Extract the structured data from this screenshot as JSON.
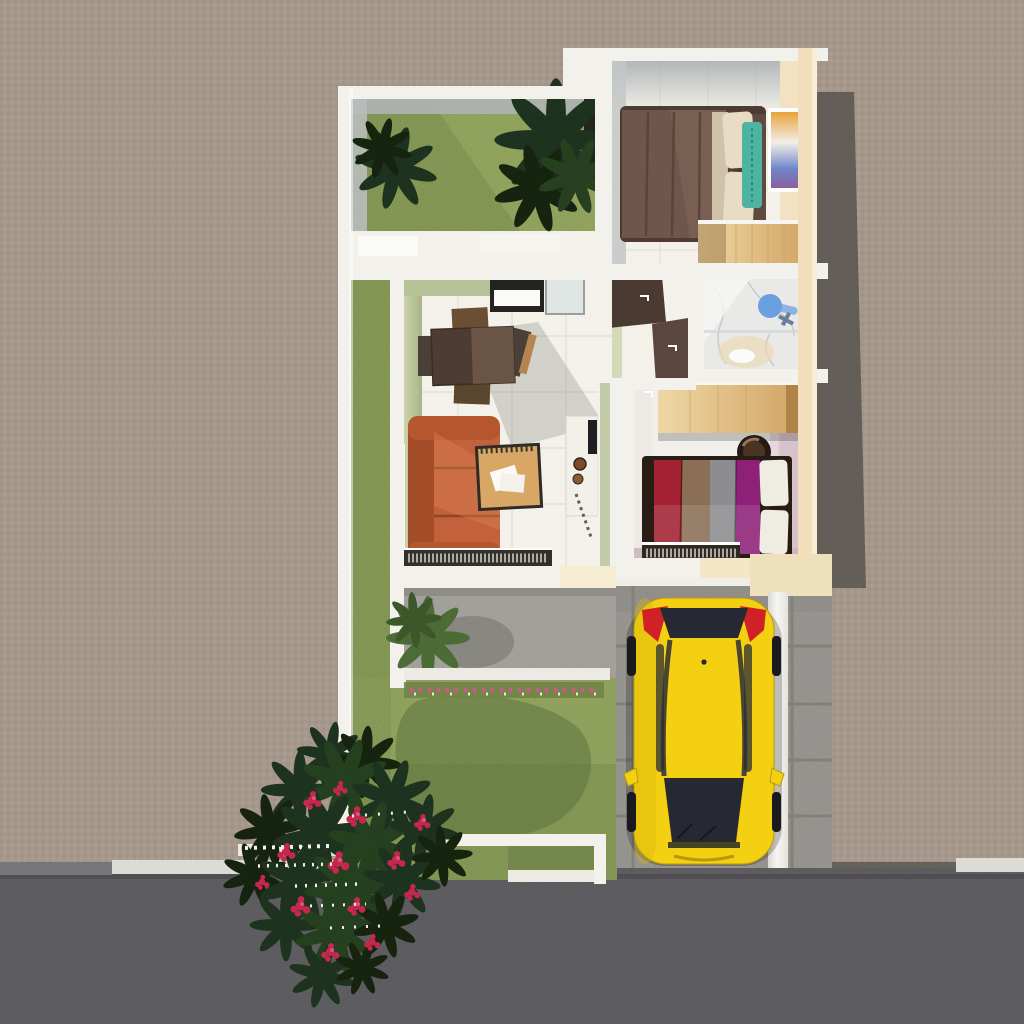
{
  "scene": {
    "view": "top-down 3d architectural render of a single-storey house lot",
    "objects": {
      "rooms": [
        "courtyard-garden",
        "bedroom-1",
        "bathroom",
        "hallway",
        "living-dining-room",
        "bedroom-2"
      ],
      "furniture": [
        "double-bed-brown",
        "teal-accent-pillow",
        "wall-artwork",
        "wood-dresser",
        "shower-head",
        "bath-fixture",
        "dark-doors",
        "dining-table",
        "dining-chairs",
        "orange-sofa",
        "coffee-table",
        "tv-console",
        "window-sill-books",
        "wood-wardrobe",
        "round-chair",
        "double-bed-striped",
        "foot-bookshelf"
      ],
      "exterior": [
        "boundary-wall",
        "side-lawn",
        "front-lawn",
        "tree-shadow",
        "terrace",
        "terrace-plant",
        "flower-bed",
        "front-fence",
        "flowering-shrub",
        "white-blossoms",
        "driveway-pavers",
        "carport-wall",
        "yellow-car",
        "asphalt-road",
        "curb",
        "house-shadow"
      ]
    }
  },
  "palette": {
    "ground": "#a59789",
    "road": "#5a595d",
    "road_edge": "#454449",
    "curb": "#dcdbd6",
    "curb_dark": "#77767a",
    "house_shadow": "#575350",
    "wall_white": "#f2f1ec",
    "wall_cream": "#f1dfbc",
    "wall_inner_gray": "#aeb4b4",
    "floor": "#f3f1ea",
    "grout": "#dcdad0",
    "sage": "#b7c298",
    "sage_light": "#cbd3ac",
    "grass": "#8a9e59",
    "grass_light": "#a6b76c",
    "grass_shadow": "#5f7340",
    "plant_dark": "#1e3220",
    "plant_terrace": "#4c6b35",
    "terrace": "#a8a6a1",
    "paver": "#9c9a95",
    "paver_joint": "#828079",
    "wood": "#e5c68f",
    "wood_deep": "#cfa263",
    "door_brown": "#4b3a31",
    "bed1_blanket": "#6f564a",
    "pillow_cream": "#e8dcc5",
    "pillow_teal": "#4fb3a2",
    "marble": "#e9e9e7",
    "marble_vein": "#c6c7c5",
    "shower_blue": "#6aa0e2",
    "pink_wall": "#d7c3cb",
    "bed2_frame": "#281c15",
    "bed2_red": "#a22231",
    "bed2_tan": "#8a6e55",
    "bed2_gray": "#8d8c90",
    "bed2_magenta": "#8e2078",
    "pillow_white": "#efece3",
    "sofa": "#c2613b",
    "sofa_dark": "#a34d29",
    "table_dark": "#4d3c32",
    "chair_wood": "#6b4f33",
    "coffee_wood": "#d8a765",
    "console_white": "#f2f0e9",
    "car_yellow": "#f4d013",
    "car_glass": "#262832",
    "car_red": "#d02127",
    "flower_crimson": "#c5274d",
    "flower_pink": "#d6548b",
    "flower_white": "#f4f2ee"
  }
}
